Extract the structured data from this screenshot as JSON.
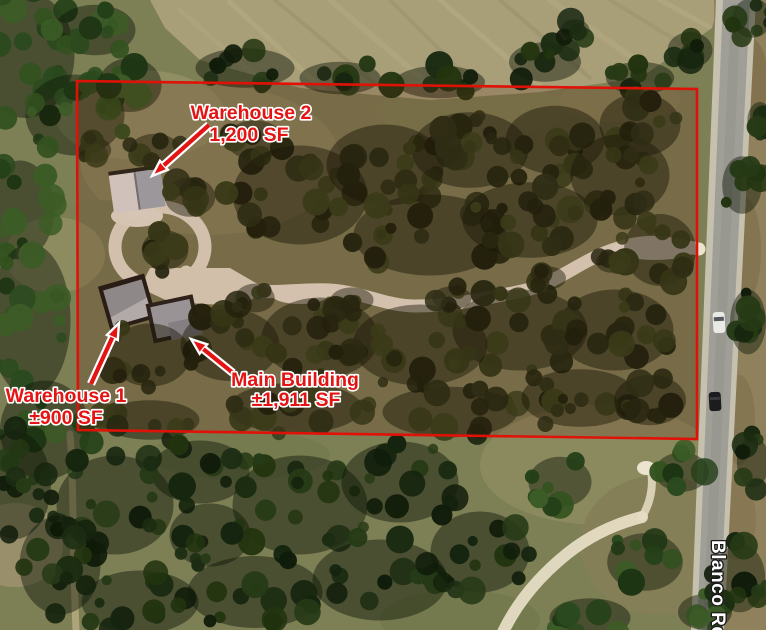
{
  "map": {
    "road_label": "Blanco Rd",
    "annotations": [
      {
        "name": "Warehouse 2",
        "size": "1,200 SF"
      },
      {
        "name": "Warehouse 1",
        "size": "±900 SF"
      },
      {
        "name": "Main Building",
        "size": "±1,911 SF"
      }
    ],
    "colors": {
      "annotation_red": "#e41414",
      "boundary_red": "#e01207",
      "label_outline": "#ffffff",
      "road_label_fill": "#ffffff",
      "road_label_outline": "#1a1a1a"
    }
  }
}
